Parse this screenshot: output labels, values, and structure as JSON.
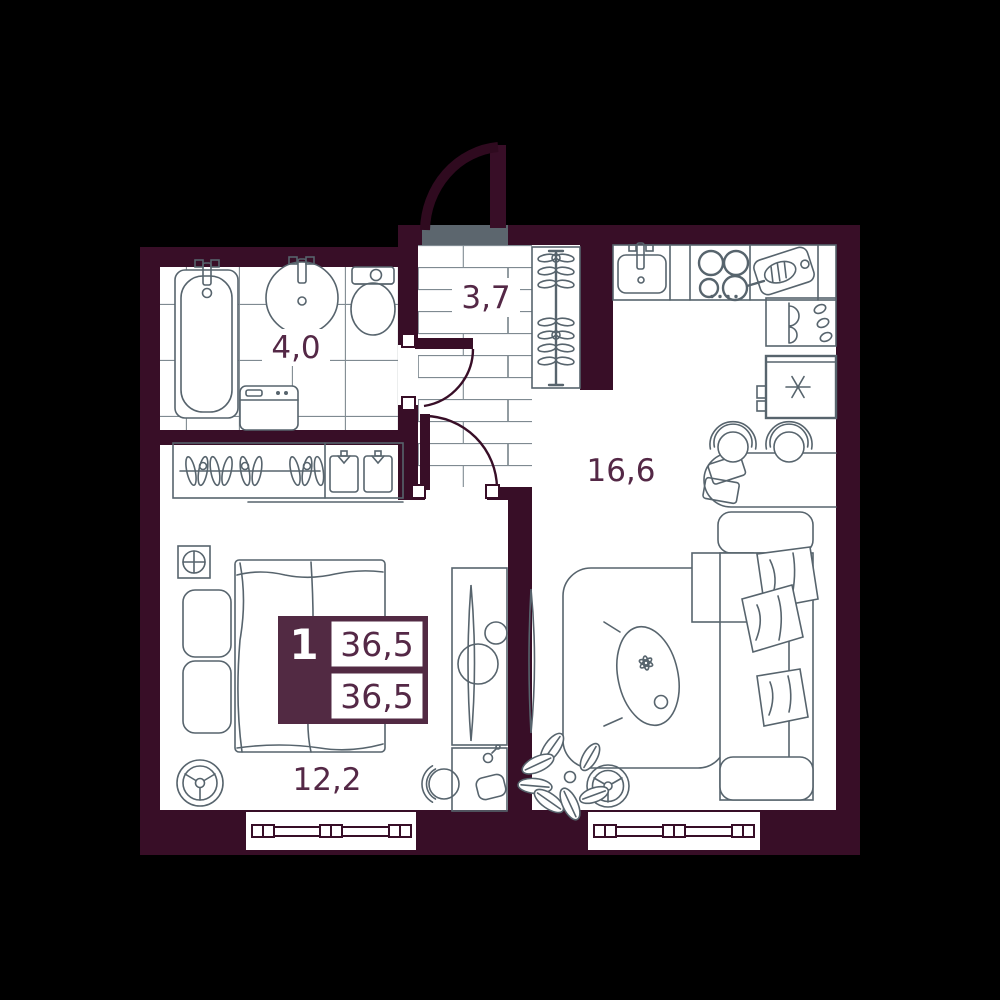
{
  "page": {
    "title": "Apartment floor plan"
  },
  "badge": {
    "apartment_number": "1",
    "total_area": "36,5",
    "living_area": "36,5"
  },
  "rooms": {
    "bathroom": {
      "area": "4,0"
    },
    "hallway": {
      "area": "3,7"
    },
    "kitchen_living": {
      "area": "16,6"
    },
    "bedroom": {
      "area": "12,2"
    }
  },
  "colors": {
    "background": "#000000",
    "wall": "#380e27",
    "accent": "#522a43",
    "area_text": "#542846",
    "fixture_line": "#57646d",
    "floor_pattern_line": "#7f8a91",
    "doormat": "#5c666e",
    "floor": "#ffffff"
  },
  "furniture": {
    "bathroom": [
      "bathtub",
      "sink",
      "toilet",
      "washing-machine"
    ],
    "hallway": [
      "entry-door",
      "doormat",
      "coat-rack",
      "interior-doors"
    ],
    "bedroom": [
      "wardrobe",
      "bed",
      "ventilation-shaft",
      "fan-wheel",
      "dressing-table",
      "chair",
      "side-table",
      "window"
    ],
    "kitchen_living": [
      "kitchen-sink",
      "stove",
      "cutting-board",
      "dish-shelf",
      "refrigerator",
      "dining-table",
      "chairs",
      "sofa",
      "throw-blankets",
      "rug",
      "coffee-table",
      "tv",
      "plant",
      "fan-wheel",
      "window"
    ]
  }
}
